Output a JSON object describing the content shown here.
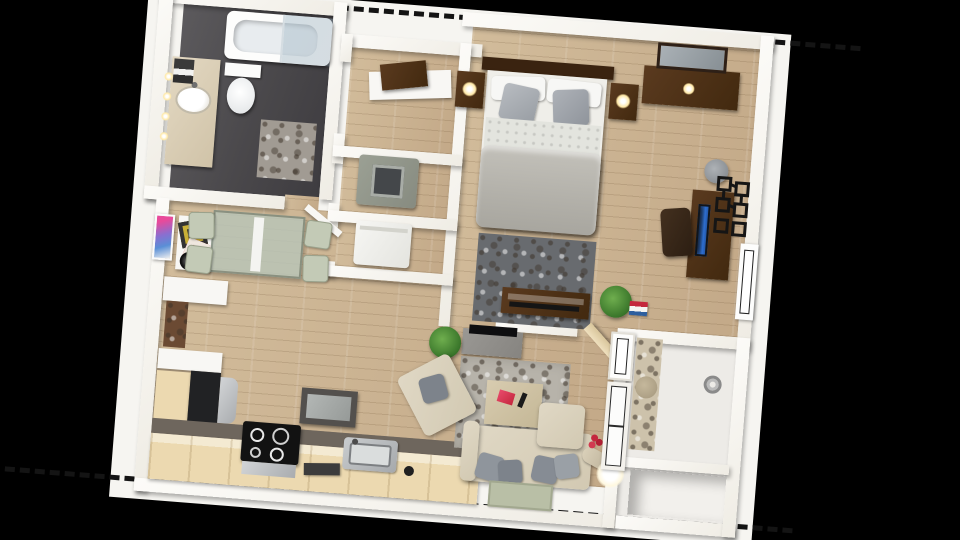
{
  "scene": {
    "title": "One-bedroom apartment 3D floor plan (top-down render)",
    "background": "#000000",
    "boundary": "dashed unit outline on white base plate"
  },
  "palette": {
    "bg": "#000000",
    "plate": "#f6f5f1",
    "dash": "#141414",
    "wall": "#efece4",
    "wood": "#d2bc9b",
    "wood-dark": "#c3a988",
    "bath-floor": "#4a484b",
    "balcony-floor": "#edebe7",
    "walnut": "#42290f",
    "counter-top": "#6e665d",
    "counter-face": "#ecd9b0",
    "steel": "#a9acaf",
    "appliance-dark": "#212224",
    "upholstery": "#d2c9b2",
    "pillow": "#9aa0a6",
    "rug-bed": "#686b6f",
    "rug-stone": "#b7b3aa",
    "sage": "#c3cab6",
    "glass-table": "#b9c4b6",
    "plant": "#39752a",
    "screen": "#2f6fd0",
    "glow": "#ffe9a8",
    "red": "#c4273d",
    "mat": "#b9bfa6"
  },
  "rooms": [
    {
      "id": "bathroom",
      "label": "Bathroom",
      "furniture": [
        "bathtub with glass screen",
        "toilet",
        "vanity with sink",
        "towel stack",
        "bath mat",
        "wall lights"
      ]
    },
    {
      "id": "hall-closet",
      "label": "Hall closet",
      "furniture": [
        "shelf",
        "storage box"
      ]
    },
    {
      "id": "laundry-closet",
      "label": "Laundry closet",
      "furniture": [
        "washer",
        "dryer"
      ]
    },
    {
      "id": "bedroom",
      "label": "Bedroom",
      "furniture": [
        "double bed with gray pillows",
        "nightstand with lamp",
        "nightstand with lamp",
        "dresser with mirror",
        "shag rug",
        "media console",
        "desk",
        "desk chair",
        "monitor",
        "desk lamp",
        "geometric wall art",
        "window",
        "plant"
      ]
    },
    {
      "id": "dining-area",
      "label": "Dining area",
      "furniture": [
        "glass dining table with runner",
        "4 chairs",
        "wall art",
        "console with records",
        "fan"
      ]
    },
    {
      "id": "kitchen",
      "label": "Kitchen",
      "furniture": [
        "open shelves",
        "patterned backsplash",
        "refrigerator",
        "counter run",
        "stove with 4 burners",
        "oven",
        "sink",
        "tray",
        "wall tv"
      ]
    },
    {
      "id": "living-room",
      "label": "Living room",
      "furniture": [
        "tv stand with tv",
        "stone rug",
        "coffee table with magazine and remote",
        "armchair",
        "sofa with gray pillows",
        "floor lamp",
        "red flowers",
        "door mat",
        "open door",
        "plant"
      ]
    },
    {
      "id": "balcony",
      "label": "Balcony / entry",
      "furniture": [
        "window",
        "sliding glass door",
        "stone strip",
        "storage nook"
      ]
    }
  ]
}
